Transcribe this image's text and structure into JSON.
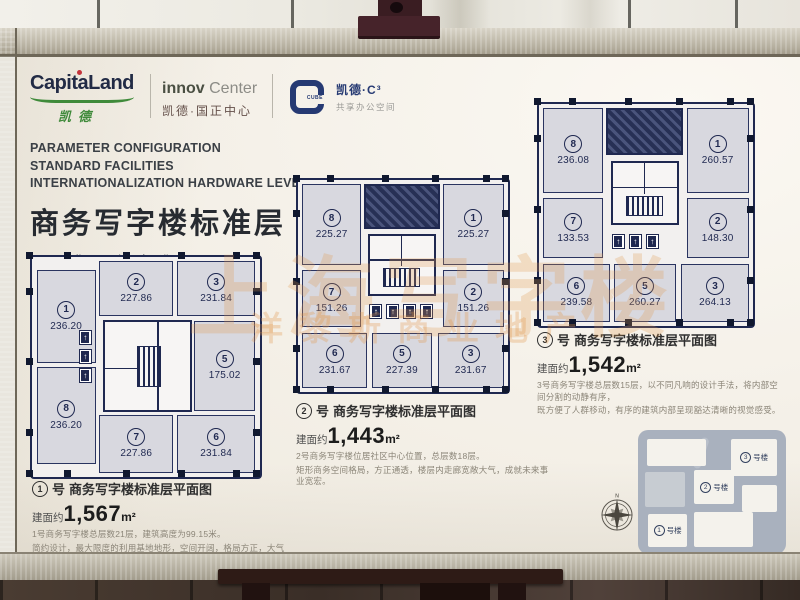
{
  "brand": {
    "capitaland": "CapitaLand",
    "capitaland_cn": "凯德",
    "innov": "innov",
    "innov2": " Center",
    "innov_cn": "凯德·国正中心",
    "cube_word": "CUBE",
    "cube_cn": "凯德·C³",
    "cube_sub": "共享办公空间"
  },
  "heading": {
    "line1": "PARAMETER CONFIGURATION",
    "line2": "STANDARD FACILITIES",
    "line3": "INTERNATIONALIZATION HARDWARE LEVEL",
    "title_cn": "商务写字楼标准层",
    "subtitle_cn": "国际化硬件水准"
  },
  "watermark": {
    "big": "上海写字楼",
    "small": "洋黎斯商业地产"
  },
  "plans": [
    {
      "no": "1",
      "suffix": "号",
      "title": "商务写字楼标准层平面图",
      "area_label": "建面约",
      "area": "1,567",
      "area_unit": "m²",
      "desc1": "1号商务写字楼总层数21层，建筑高度为99.15米。",
      "desc2": "简约设计，最大限度的利用基地地形，空间开阔，格局方正，大气持重。",
      "units": [
        {
          "no": "1",
          "area": "236.20"
        },
        {
          "no": "2",
          "area": "227.86"
        },
        {
          "no": "3",
          "area": "231.84"
        },
        {
          "no": "5",
          "area": "175.02"
        },
        {
          "no": "6",
          "area": "231.84"
        },
        {
          "no": "7",
          "area": "227.86"
        },
        {
          "no": "8",
          "area": "236.20"
        }
      ]
    },
    {
      "no": "2",
      "suffix": "号",
      "title": "商务写字楼标准层平面图",
      "area_label": "建面约",
      "area": "1,443",
      "area_unit": "m²",
      "desc1": "2号商务写字楼位居社区中心位置，总层数18层。",
      "desc2": "矩形商务空间格局，方正通透，楼层内走廊宽敞大气，成就未来事业宽宏。",
      "units": [
        {
          "no": "1",
          "area": "225.27"
        },
        {
          "no": "2",
          "area": "151.26"
        },
        {
          "no": "3",
          "area": "231.67"
        },
        {
          "no": "5",
          "area": "227.39"
        },
        {
          "no": "6",
          "area": "231.67"
        },
        {
          "no": "7",
          "area": "151.26"
        },
        {
          "no": "8",
          "area": "225.27"
        }
      ]
    },
    {
      "no": "3",
      "suffix": "号",
      "title": "商务写字楼标准层平面图",
      "area_label": "建面约",
      "area": "1,542",
      "area_unit": "m²",
      "desc1": "3号商务写字楼总层数15层，以不同凡响的设计手法，将内部空间分割的动静有序，",
      "desc2": "既方便了人群移动，有序的建筑内部呈现豁达清晰的视觉感受。",
      "units": [
        {
          "no": "1",
          "area": "260.57"
        },
        {
          "no": "2",
          "area": "148.30"
        },
        {
          "no": "3",
          "area": "264.13"
        },
        {
          "no": "5",
          "area": "260.27"
        },
        {
          "no": "6",
          "area": "239.58"
        },
        {
          "no": "7",
          "area": "133.53"
        },
        {
          "no": "8",
          "area": "236.08"
        }
      ]
    }
  ],
  "sitemap": {
    "labels": [
      {
        "no": "3",
        "text": "号楼"
      },
      {
        "no": "2",
        "text": "号楼"
      },
      {
        "no": "1",
        "text": "号楼"
      }
    ],
    "compass": "N"
  },
  "colors": {
    "plan_line": "#1f2850",
    "unit_fill": "#d8d8df",
    "board": "#f5f1e9",
    "watermark": "#e09648",
    "frame": "#b7b1a1"
  }
}
